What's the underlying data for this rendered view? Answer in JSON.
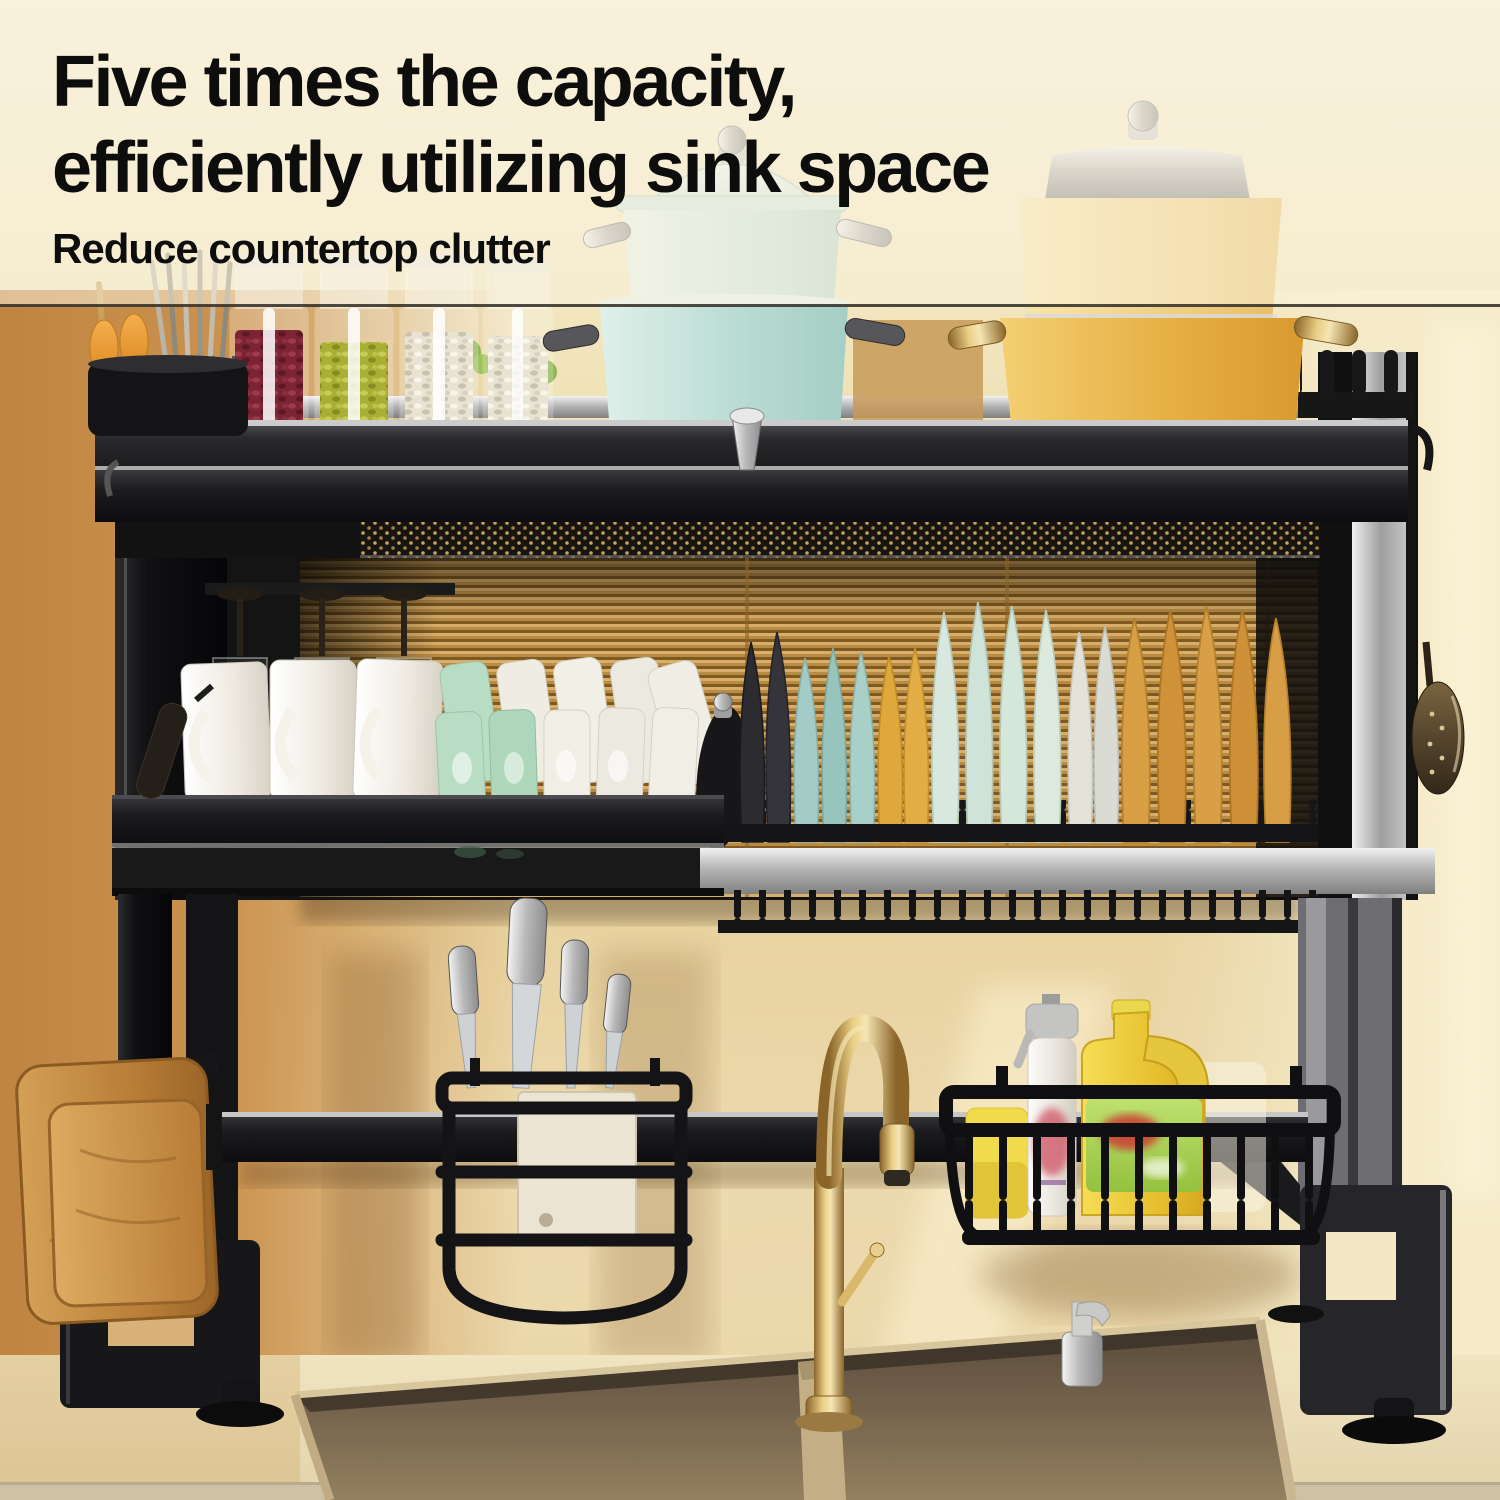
{
  "overlay_text": {
    "headline_line1": "Five times the capacity,",
    "headline_line2": "efficiently utilizing sink space",
    "subheadline": "Reduce countertop clutter"
  },
  "palette": {
    "backdrop_cream": "#f4ecd4",
    "wall_amber": "#c9914e",
    "ribbed_glass_amber": "#c89a55",
    "rack_black": "#161616",
    "steel_silver": "#c9c9c9",
    "pot_mint": "#cfe8e0",
    "pot_teal": "#aed6ce",
    "pot_pale_yellow": "#f0d388",
    "pot_yellow": "#e9b84d",
    "plate_teal": "#a3ccc6",
    "plate_yellow": "#dfa83d",
    "plate_amber": "#d79e44",
    "plate_mint": "#d9e8de",
    "cup_green": "#b9dcc4",
    "ceramic_white": "#f1eee6",
    "beans_red": "#7c2433",
    "beans_green": "#a9af35",
    "beans_white": "#e9e3d3",
    "faucet_brass": "#c9a255",
    "sink_bronze": "#6e5c46",
    "detergent_yellow": "#ecc93e",
    "label_green": "#9ccf4a",
    "sponge_yellow": "#f0dc4a",
    "wood_tan": "#c08a46",
    "text_black": "#0d0d0d"
  },
  "scene": {
    "description": "Black two-tier over-the-sink dish drying rack standing over a double stainless sink against a warm beige kitchen wall",
    "objects": [
      "utensil-holder-with-chopsticks",
      "spice-jar-red-beans",
      "spice-jar-green-beans",
      "spice-jar-white-beans-1",
      "spice-jar-white-beans-2",
      "mint-pot-stack-with-lid",
      "yellow-pot-stack-with-steamer",
      "wine-glasses-hanging",
      "white-mugs",
      "green-cups",
      "white-cups",
      "plate-rack-with-colored-plates",
      "black-pot-lid",
      "knife-holder-with-knives",
      "white-cleaver",
      "wire-basket",
      "yellow-sponge",
      "white-spray-bottle",
      "yellow-detergent-jug",
      "wooden-cutting-boards",
      "brass-gooseneck-faucet",
      "chrome-soap-pump",
      "double-basin-sink",
      "hanging-ladle",
      "hanging-spatula"
    ]
  }
}
